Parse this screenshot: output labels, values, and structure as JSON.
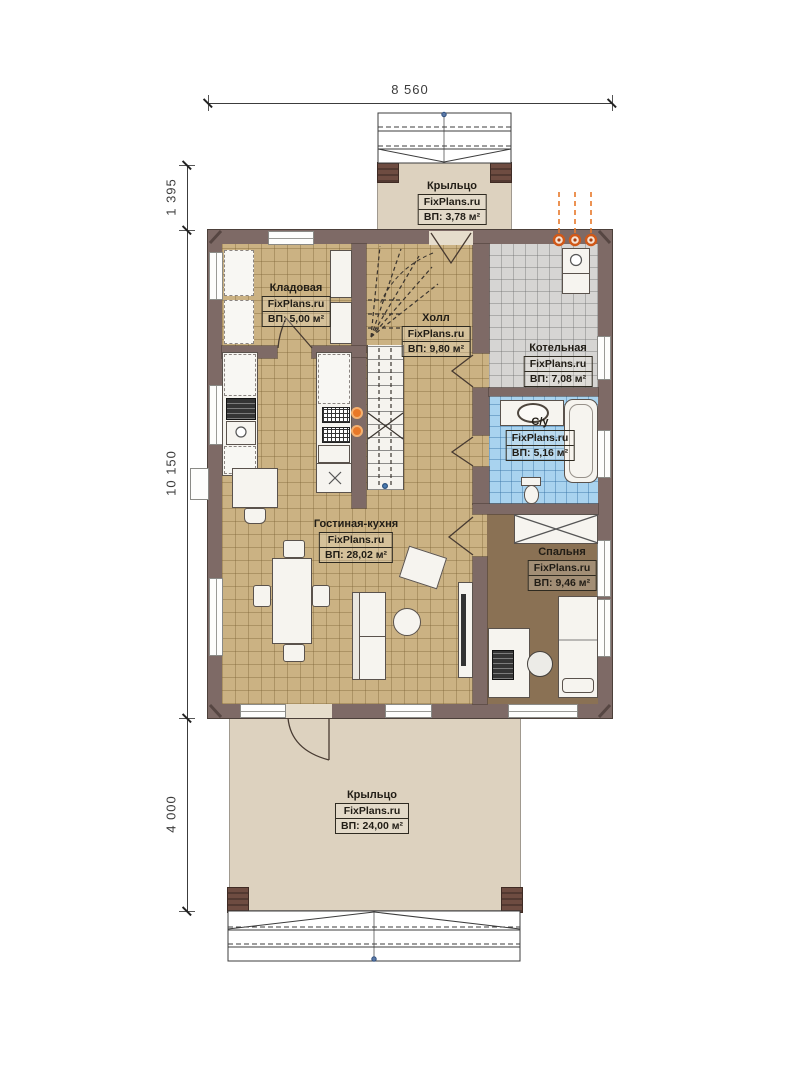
{
  "plan": {
    "title": "Floor plan (first floor) — FixPlans.ru",
    "dimensions": {
      "width_top": "8 560",
      "height_porch_top": "1 395",
      "height_main": "10 150",
      "height_porch_bottom": "4 000"
    },
    "rooms": {
      "porch_top": {
        "name": "Крыльцо",
        "brand": "FixPlans.ru",
        "area": "ВП: 3,78 м²"
      },
      "storage": {
        "name": "Кладовая",
        "brand": "FixPlans.ru",
        "area": "ВП: 5,00 м²"
      },
      "hall": {
        "name": "Холл",
        "brand": "FixPlans.ru",
        "area": "ВП: 9,80 м²"
      },
      "boiler": {
        "name": "Котельная",
        "brand": "FixPlans.ru",
        "area": "ВП: 7,08 м²"
      },
      "bathroom": {
        "name": "С/у",
        "brand": "FixPlans.ru",
        "area": "ВП: 5,16 м²"
      },
      "living_kitchen": {
        "name": "Гостиная-кухня",
        "brand": "FixPlans.ru",
        "area": "ВП: 28,02 м²"
      },
      "bedroom": {
        "name": "Спальня",
        "brand": "FixPlans.ru",
        "area": "ВП: 9,46 м²"
      },
      "porch_bottom": {
        "name": "Крыльцо",
        "brand": "FixPlans.ru",
        "area": "ВП: 24,00 м²"
      }
    },
    "colors": {
      "wall": "#7e6a66",
      "floor_tan": "#cbb283",
      "floor_gray": "#d6d5d3",
      "floor_blue": "#a9d3ef",
      "floor_bedroom": "#8a7154",
      "floor_porch": "#ddd2bf",
      "flame_accent": "#e06820"
    }
  }
}
